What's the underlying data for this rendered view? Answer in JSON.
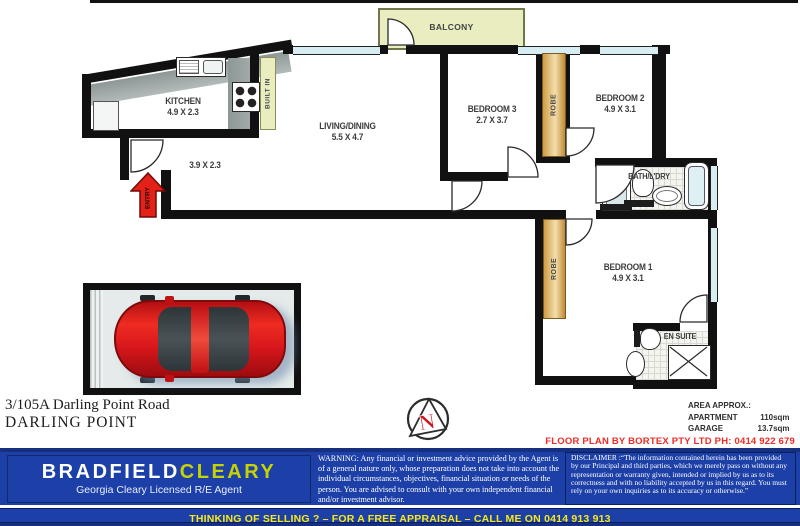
{
  "plan": {
    "rooms": {
      "balcony": {
        "label": "BALCONY"
      },
      "kitchen": {
        "label": "KITCHEN",
        "dims": "4.9 X 2.3"
      },
      "living": {
        "label": "LIVING/DINING",
        "dims": "5.5 X 4.7"
      },
      "bedroom3": {
        "label": "BEDROOM 3",
        "dims": "2.7 X 3.7"
      },
      "bedroom2": {
        "label": "BEDROOM 2",
        "dims": "4.9 X 3.1"
      },
      "bedroom1": {
        "label": "BEDROOM 1",
        "dims": "4.9 X 3.1"
      },
      "bath": {
        "label": "BATH/L'DRY"
      },
      "ensuite": {
        "label": "EN SUITE"
      },
      "hall": {
        "dims": "3.9 X 2.3"
      },
      "robe": {
        "label": "ROBE"
      },
      "robe2": {
        "label": "ROBE"
      },
      "builtin": {
        "label": "BUILT IN"
      },
      "entry": {
        "label": "ENTRY"
      }
    },
    "compass": {
      "letter": "N"
    },
    "area": {
      "title": "AREA APPROX.:",
      "rows": [
        {
          "name": "APARTMENT",
          "value": "110sqm"
        },
        {
          "name": "GARAGE",
          "value": "13.7sqm"
        }
      ]
    },
    "credit": "FLOOR PLAN BY BORTEX PTY LTD PH: 0414 922 679"
  },
  "address": {
    "line1": "3/105A Darling Point Road",
    "line2": "DARLING POINT"
  },
  "footer": {
    "brand": {
      "part1": "BRADFIELD",
      "part2": "CLEARY",
      "tagline": "Georgia Cleary Licensed R/E Agent"
    },
    "warning": "WARNING: Any financial or investment advice provided by the Agent is of a general nature only, whose preparation does not take into account the individual circumstances, objectives, financial situation or needs of the person.  You are advised to consult with your own independent financial and/or investment advisor.",
    "disclaimer": "DISCLAIMER :“The information contained herein has been provided by our Principal and third parties, which we merely pass on without any representation or warranty given, intended or implied by us as to its correctness and with no liability accepted by us in this regard. You must rely on your own inquiries as to its accuracy or otherwise.”",
    "cta": "THINKING OF SELLING ? – FOR A FREE APPRAISAL – CALL ME ON 0414 913 913"
  },
  "colors": {
    "wall": "#111111",
    "window_blue": "#d8edf1",
    "balcony_green": "#e9edbf",
    "robe_tan": "#d9a85a",
    "counter_gray": "#97a1a0",
    "car_red": "#d6161b",
    "arrow_red": "#e32119",
    "credit_red": "#ee2b24",
    "footer_blue": "#1d40a8",
    "footer_navy": "#16307f",
    "brand_yellow": "#c6d300",
    "cta_yellow": "#f7e919"
  }
}
